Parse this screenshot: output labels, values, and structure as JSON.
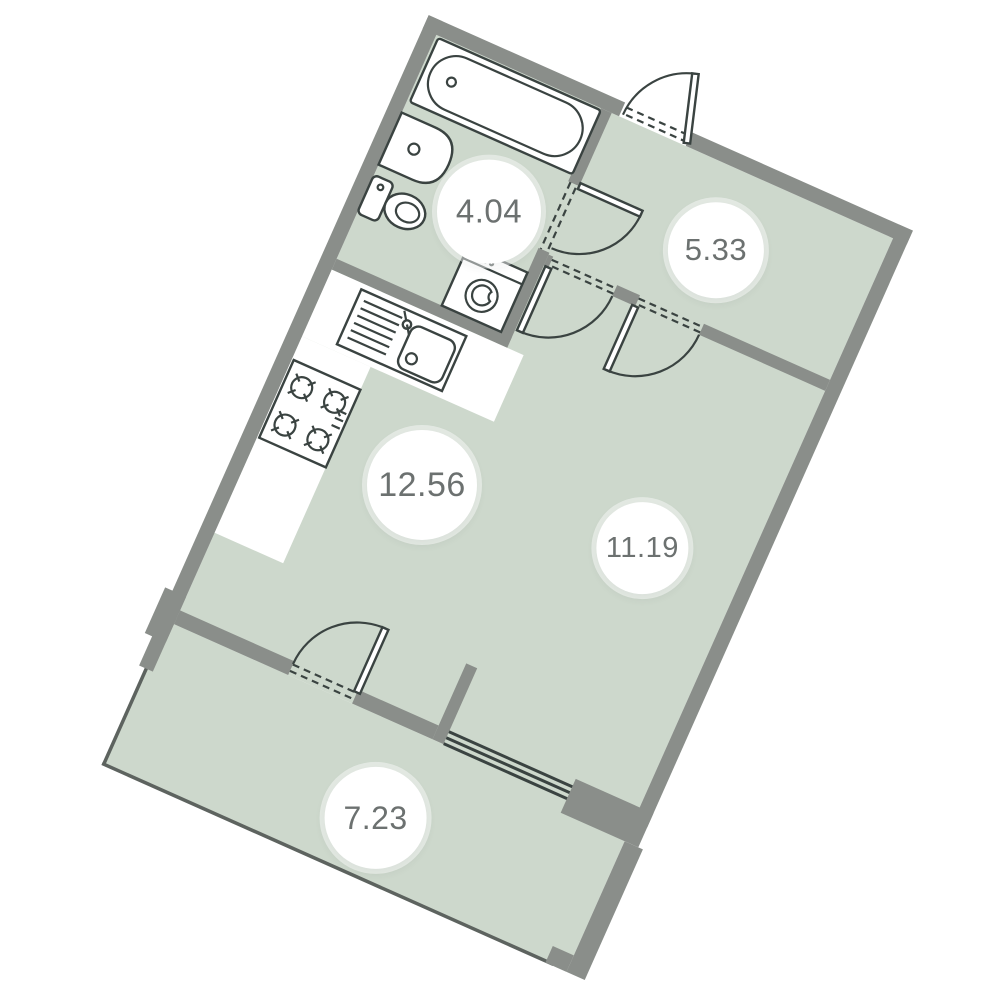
{
  "floor_plan": {
    "rotation_deg": 24,
    "colors": {
      "wall": "#8a8e8a",
      "floor": "#cdd8cc",
      "outline": "#3a4341",
      "label_text": "#6c7170",
      "background": "#ffffff",
      "fixture_fill": "#ffffff"
    },
    "rooms": [
      {
        "id": "bathroom",
        "area_label": "4.04"
      },
      {
        "id": "hallway",
        "area_label": "5.33"
      },
      {
        "id": "kitchen-living",
        "area_label": "12.56"
      },
      {
        "id": "room",
        "area_label": "11.19"
      },
      {
        "id": "balcony",
        "area_label": "7.23"
      }
    ],
    "fixtures": [
      "bathtub",
      "washbasin",
      "toilet",
      "washing-machine",
      "kitchen-sink",
      "stove-4-burner"
    ],
    "features": [
      "entrance-door",
      "bathroom-door",
      "living-room-door",
      "room-door",
      "balcony-door",
      "window",
      "balcony-glazing"
    ]
  }
}
